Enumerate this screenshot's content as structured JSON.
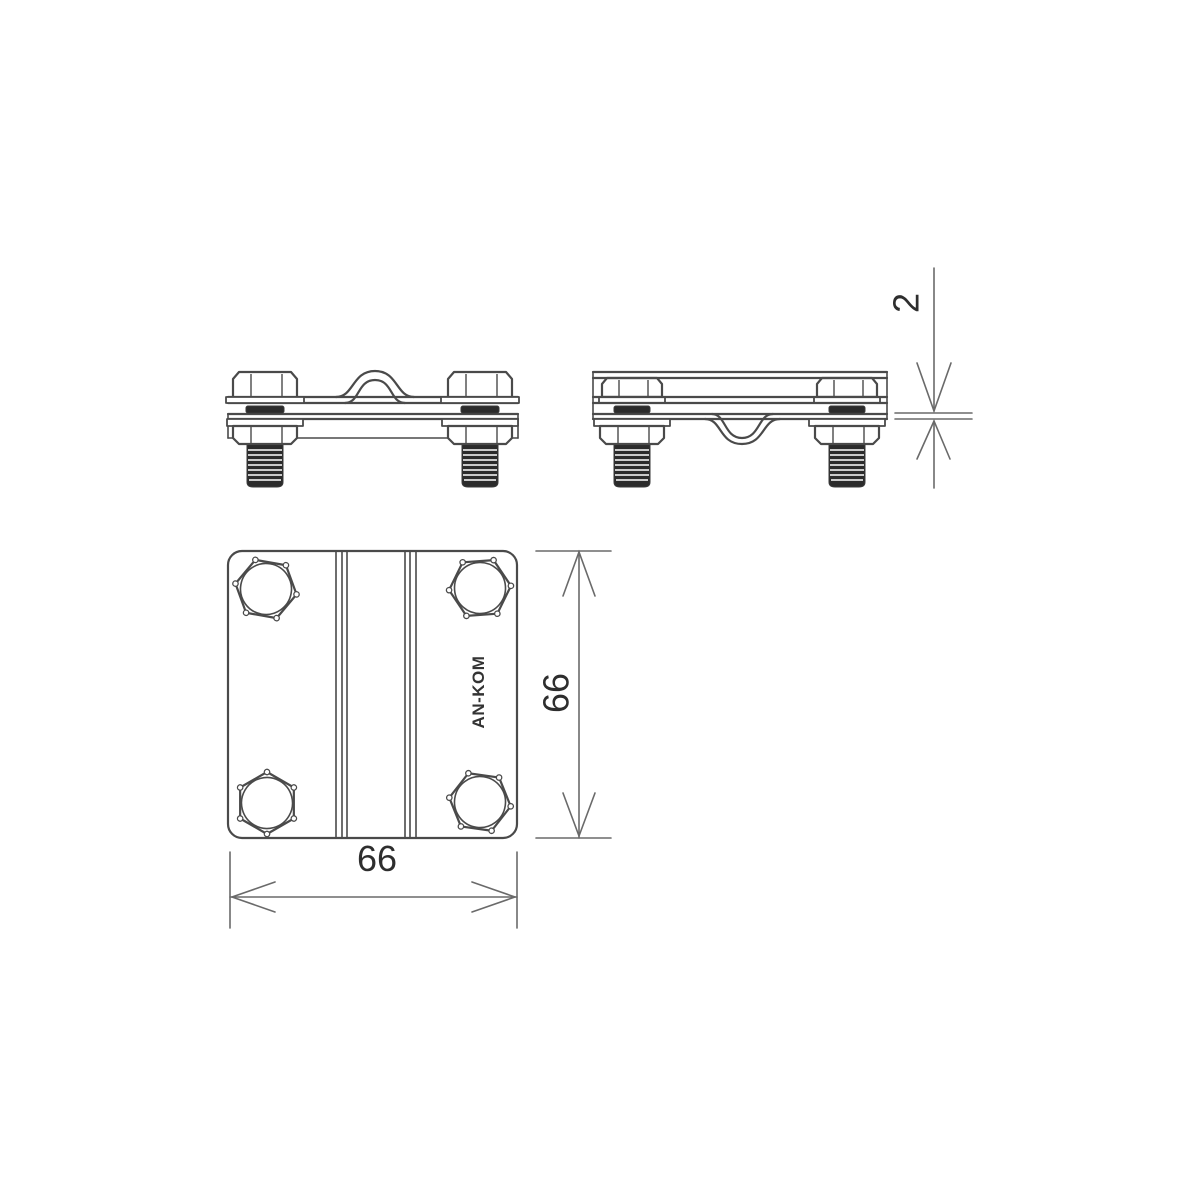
{
  "drawing": {
    "brand": "AN-KOM",
    "dimensions": {
      "plate_width_mm": "66",
      "plate_height_mm": "66",
      "plate_thickness_mm": "2"
    },
    "colors": {
      "outline": "#4a4a4a",
      "dimension_line": "#6a6a6a",
      "thread_dark": "#2b2b2b",
      "label_text": "#2e2e2e",
      "background": "#ffffff"
    }
  }
}
